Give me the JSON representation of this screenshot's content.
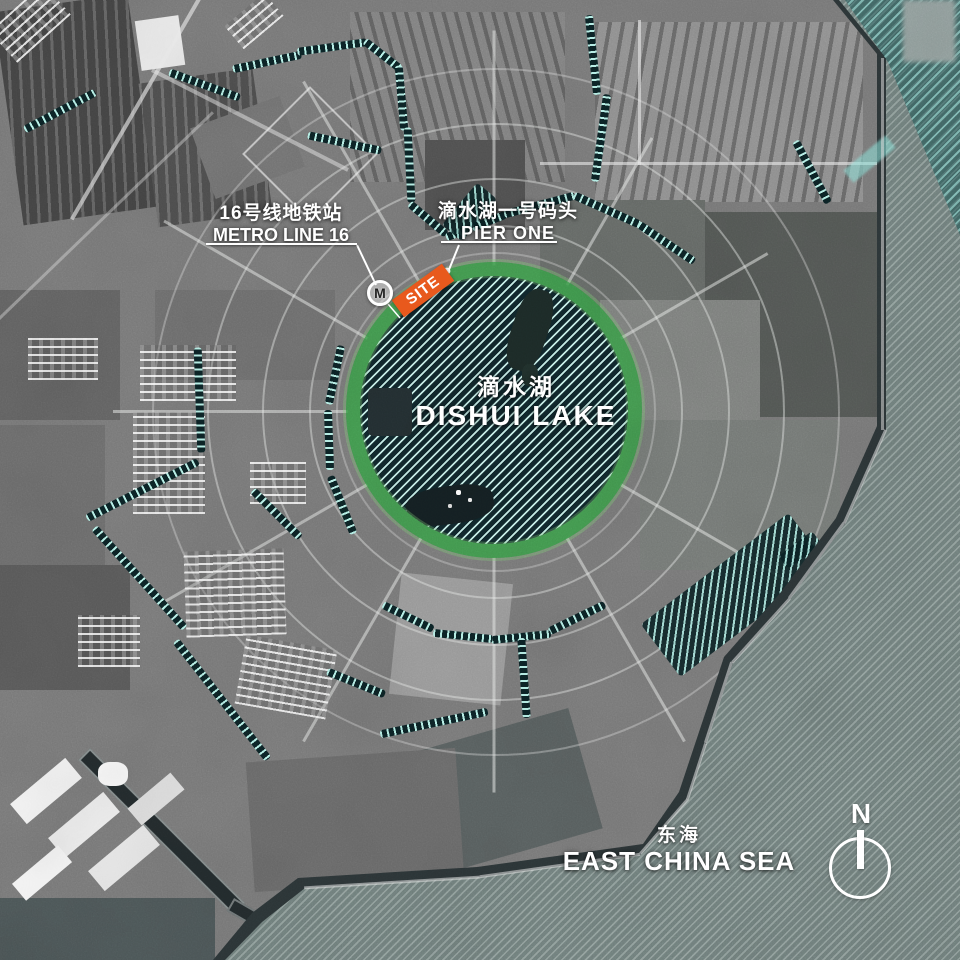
{
  "annotations": {
    "metro": {
      "zh": "16号线地铁站",
      "en": "METRO LINE 16"
    },
    "pier": {
      "zh": "滴水湖一号码头",
      "en": "PIER ONE"
    },
    "lake": {
      "zh": "滴水湖",
      "en": "DISHUI LAKE"
    },
    "sea": {
      "zh": "东海",
      "en": "EAST CHINA SEA"
    },
    "site": {
      "label": "SITE"
    },
    "metro_icon": {
      "letter": "M"
    },
    "compass": {
      "letter": "N"
    }
  },
  "colors": {
    "site_orange": "#e8591d",
    "lake_ring_green": "#37a046",
    "hatch_teal": "#b7f1e8",
    "canal_dark": "#0c2326",
    "sea_gray": "#71807d",
    "land_gray": "#797979"
  }
}
